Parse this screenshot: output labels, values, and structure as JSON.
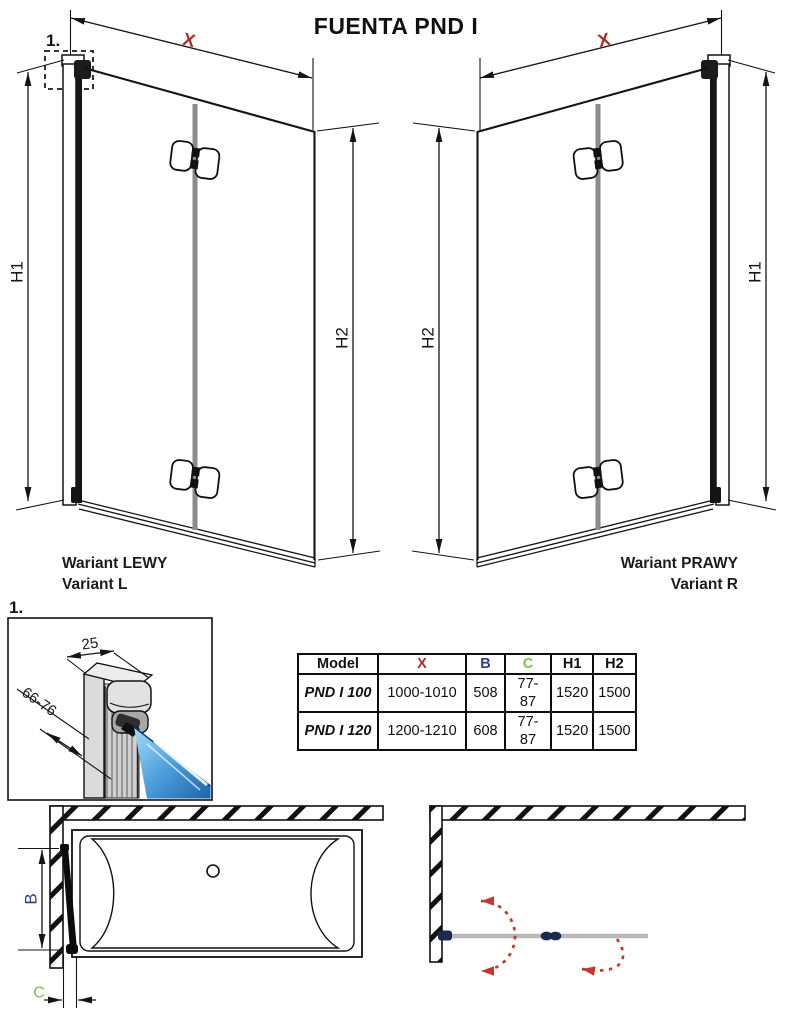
{
  "title": "FUENTA PND I",
  "labels": {
    "x": "X",
    "h1": "H1",
    "h2": "H2",
    "detail_ref": "1.",
    "detail_width": "25",
    "detail_depth": "66-76",
    "tub_b": "B",
    "tub_c": "C"
  },
  "variants": {
    "left": {
      "line1": "Wariant LEWY",
      "line2": "Variant L"
    },
    "right": {
      "line1": "Wariant PRAWY",
      "line2": "Variant R"
    }
  },
  "table": {
    "headers": {
      "model": "Model",
      "x": "X",
      "b": "B",
      "c": "C",
      "h1": "H1",
      "h2": "H2"
    },
    "rows": [
      {
        "model": "PND I 100",
        "x": "1000-1010",
        "b": "508",
        "c": "77-87",
        "h1": "1520",
        "h2": "1500"
      },
      {
        "model": "PND I 120",
        "x": "1200-1210",
        "b": "608",
        "c": "77-87",
        "h1": "1520",
        "h2": "1500"
      }
    ]
  },
  "colors": {
    "dim_red": "#b02a24",
    "dim_blue": "#2b3e8f",
    "dim_green": "#7cc142",
    "arc_red": "#bf3b2f",
    "hinge_navy": "#1b2a4e",
    "screen_gray": "#b9b9b9",
    "glass_blue_light": "#a6dcf7",
    "glass_blue_dark": "#1c63a8"
  }
}
